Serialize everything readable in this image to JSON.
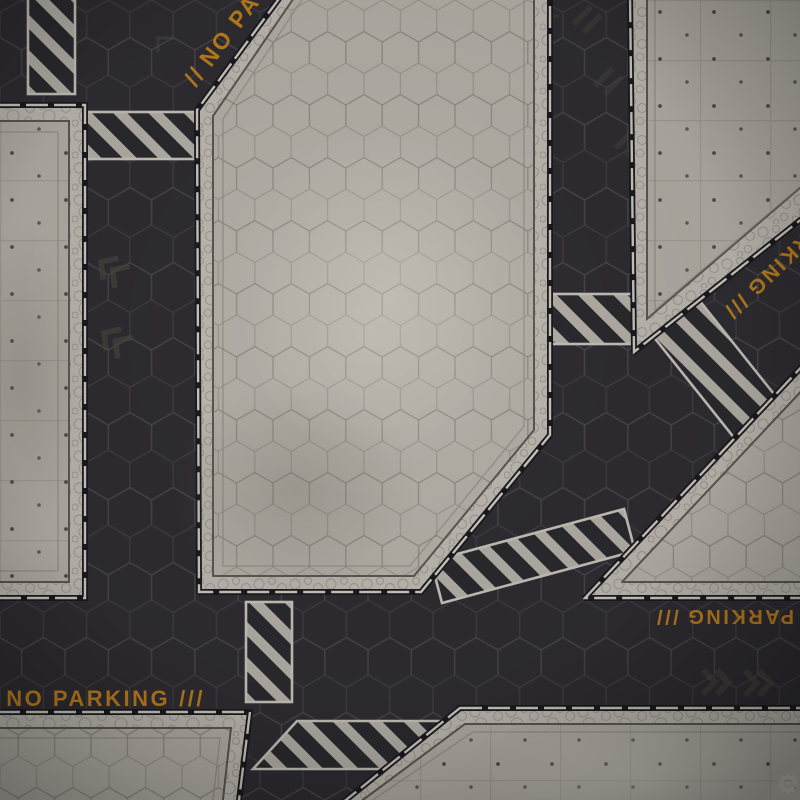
{
  "scene": {
    "description": "Sci-fi tabletop battle mat — top-down industrial district floor with hex streets, concrete platforms, hazard stripes and painted street markings"
  },
  "palette": {
    "floor": "#2f2d32",
    "hex_line": "#4d4b51",
    "platform_concrete": "#b2ada5",
    "border_band": "#bdb8b0",
    "edge_dark": "#1b1a1e",
    "trim_light": "#cac6be",
    "hazard_stripe": "#b3afa7",
    "marking_orange": "#c8861d"
  },
  "markings": {
    "no_parking": "NO PARKING",
    "parking": "PARKING",
    "slashes2": "//",
    "slashes3": "///"
  },
  "icons": {
    "logo": "gear-icon",
    "logo_glyph": "⚙",
    "street_glyphs": [
      "chevron-icon",
      "corner-bracket-icon",
      "diagonal-dash-icon"
    ]
  }
}
